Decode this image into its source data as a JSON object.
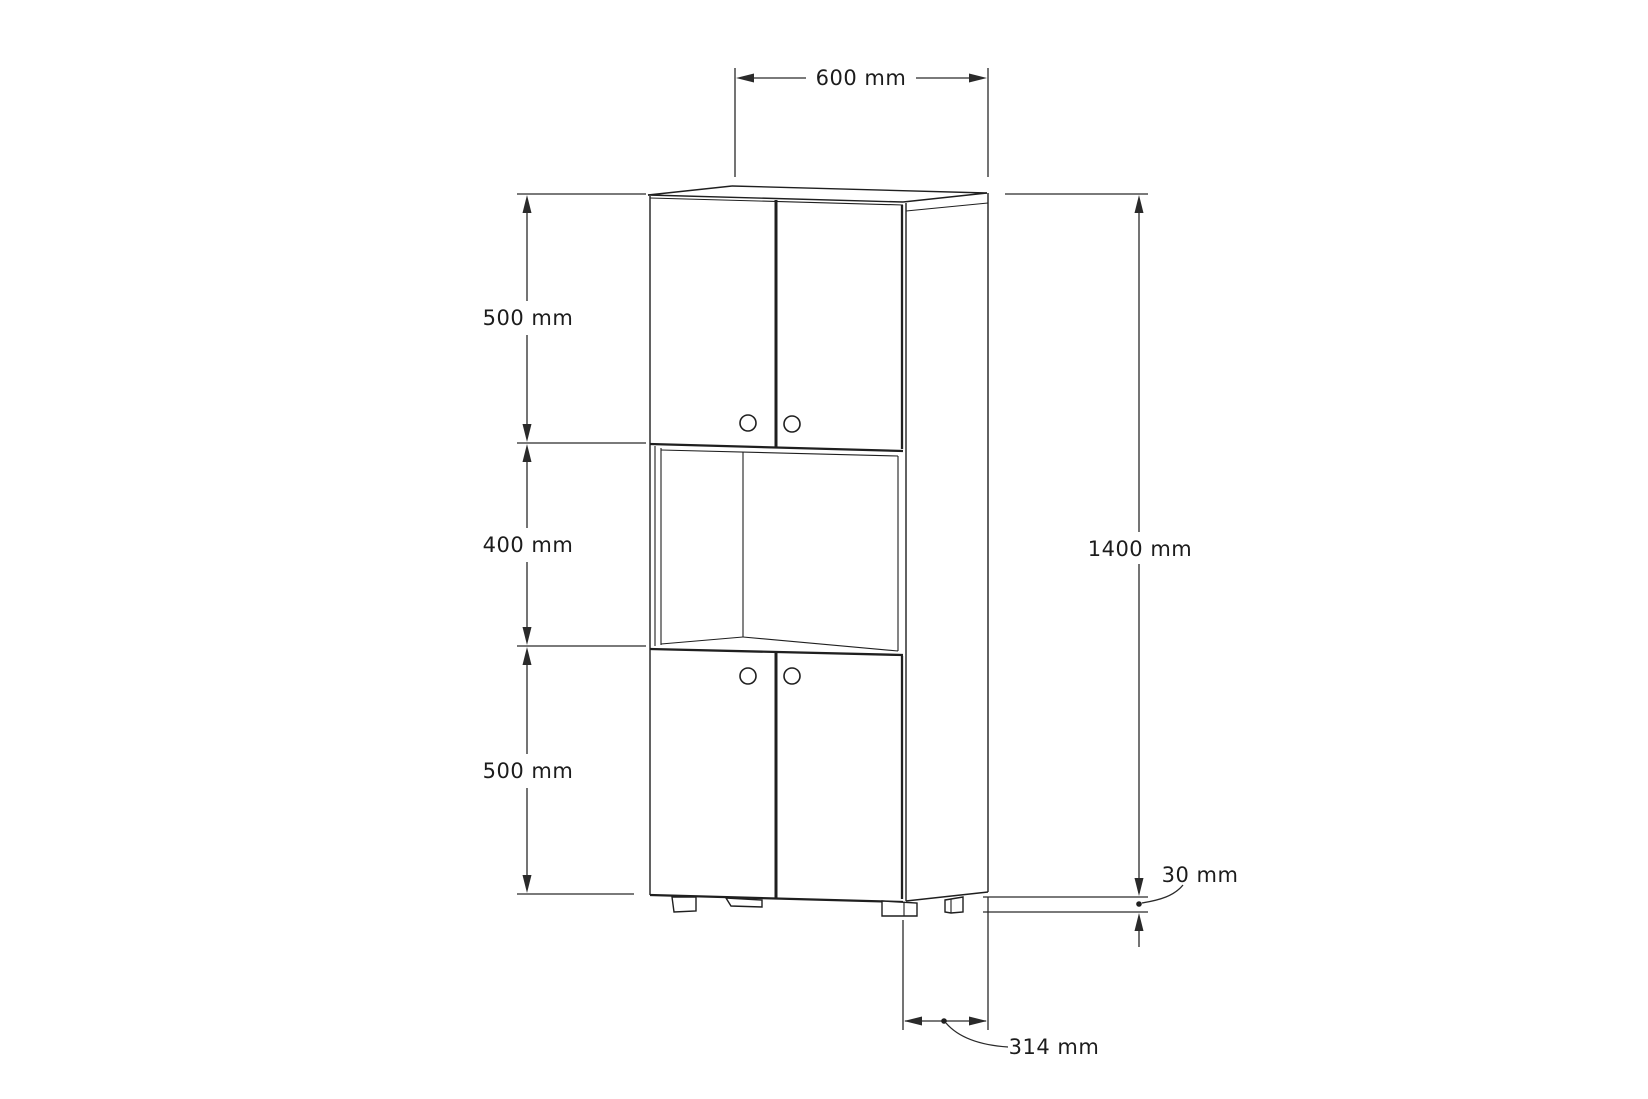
{
  "drawing": {
    "subject": "tall-two-door-cabinet-technical-drawing",
    "view": "front-oblique",
    "units": "mm",
    "colors": {
      "line": "#1f1f1f",
      "background": "#ffffff",
      "text": "#1c1c1c"
    },
    "labels": {
      "width_top": "600 mm",
      "upper_section_height": "500 mm",
      "middle_section_height": "400 mm",
      "lower_section_height": "500 mm",
      "total_height": "1400 mm",
      "leg_height": "30 mm",
      "depth": "314 mm"
    },
    "measurements": {
      "width_mm": 600,
      "upper_section_mm": 500,
      "middle_section_mm": 400,
      "lower_section_mm": 500,
      "total_height_mm": 1400,
      "leg_height_mm": 30,
      "depth_mm": 314
    }
  }
}
